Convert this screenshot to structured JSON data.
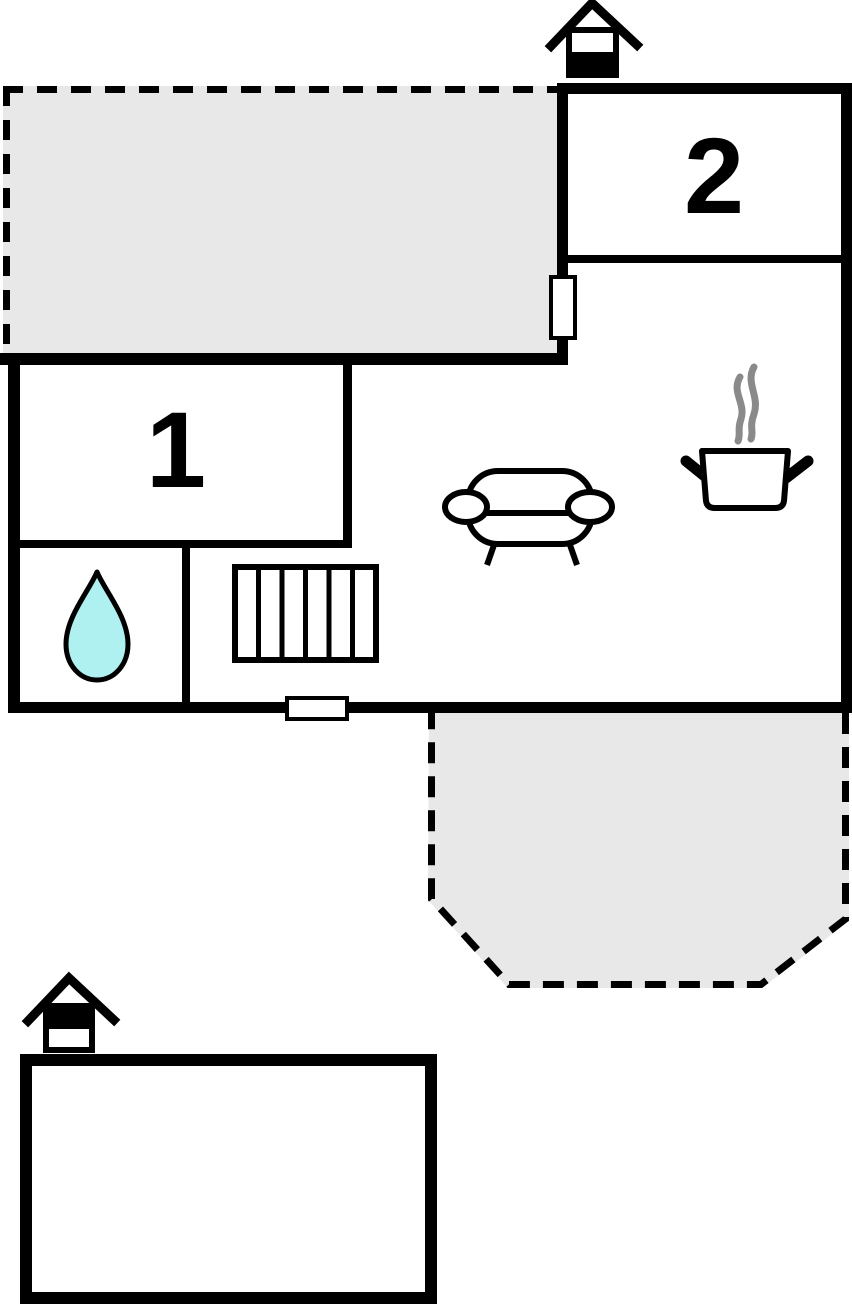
{
  "floorplan": {
    "rooms": [
      {
        "label": "1"
      },
      {
        "label": "2"
      }
    ],
    "colors": {
      "wall": "#000000",
      "terrace": "#e8e8e8",
      "water": "#aff0f1",
      "steam": "#8a8a8a",
      "background": "#ffffff"
    },
    "icons": {
      "chimney_top": "house-chimney",
      "chimney_outbuilding": "house-chimney",
      "sofa": "sofa-top-view",
      "cooking_pot": "steaming-pot",
      "water_drop": "droplet",
      "stairs": "staircase-top-view",
      "window_living": "window-in-wall",
      "door_bottom": "door-in-wall"
    },
    "areas": {
      "terrace_top": "dashed-terrace",
      "terrace_bottom": "dashed-terrace",
      "outbuilding": "annex-building"
    }
  }
}
